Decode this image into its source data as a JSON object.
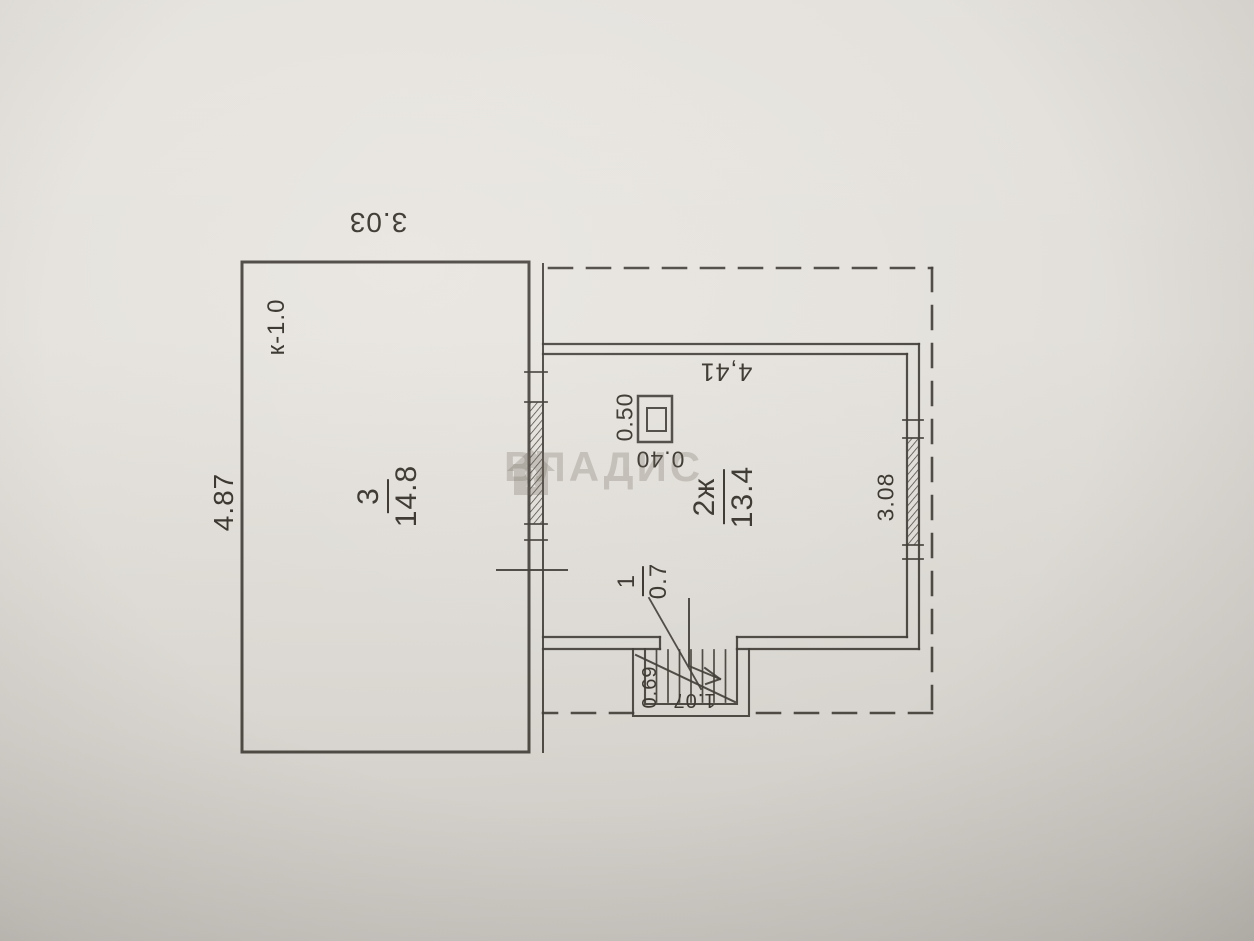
{
  "photo": {
    "description": "scanned BTI floor plan photographed on grey paper",
    "paper_color": "#e4e1dc",
    "ink_color": "#3d3a34"
  },
  "watermark": {
    "brand": "ВЛАДИС",
    "icon": "house-icon"
  },
  "plan": {
    "rooms": [
      {
        "number": "3",
        "area": "14.8"
      },
      {
        "number": "2ж",
        "area": "13.4"
      },
      {
        "number": "1",
        "area": "0.7"
      }
    ],
    "annotations": {
      "wall_mark": "к-1.0",
      "dim_top": "3.03",
      "dim_left": "4.87",
      "dim_room2_top": "4,41",
      "dim_room2_right": "3.08",
      "stove_width": "0.50",
      "stove_depth": "0.40",
      "stair_width": "0.69",
      "stair_length": "1.07"
    },
    "symbols": [
      "stove",
      "staircase-with-arrow",
      "windows-hatched",
      "veranda-dashed-outline"
    ]
  }
}
